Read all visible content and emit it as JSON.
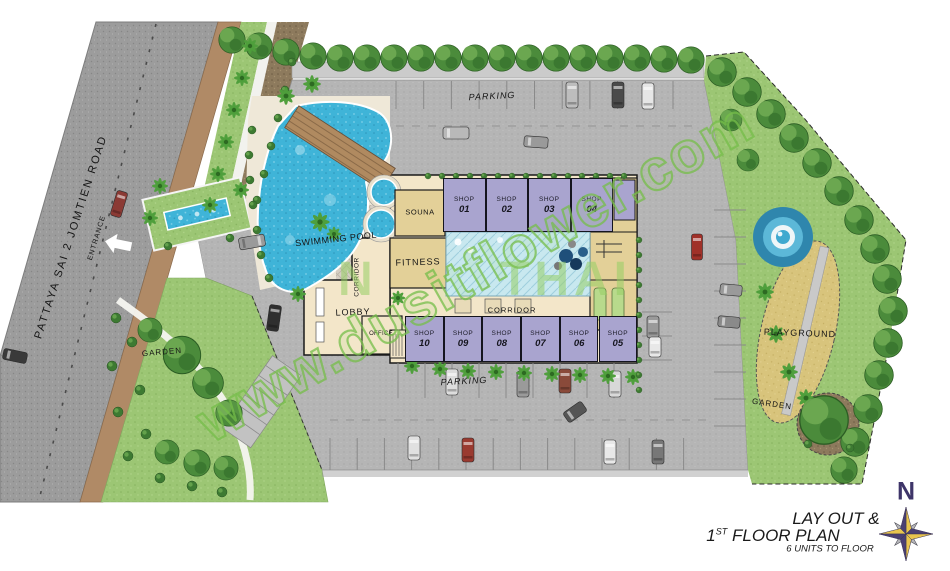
{
  "watermark": {
    "text": "www.dusitflower.com",
    "fragments": [
      "N",
      "THAI"
    ]
  },
  "road": {
    "label": "PATTAYA SAI 2 JOMTIEN ROAD",
    "entrance_label": "ENTRANCE"
  },
  "site": {
    "parking_top_label": "PARKING",
    "parking_bottom_label": "PARKING",
    "garden_left_label": "GARDEN",
    "garden_right_label": "GARDEN",
    "playground_label": "PLAYGROUND"
  },
  "building": {
    "swimming_pool_label": "SWIMMING POOL",
    "sauna_label": "SOUNA",
    "fitness_label": "FITNESS",
    "lobby_label": "LOBBY",
    "office_label": "OFFICE",
    "corridor_vertical_label": "CORRIDOR",
    "corridor_label": "CORRIDOR",
    "shops_top": [
      {
        "name": "SHOP",
        "number": "01"
      },
      {
        "name": "SHOP",
        "number": "02"
      },
      {
        "name": "SHOP",
        "number": "03"
      },
      {
        "name": "SHOP",
        "number": "04"
      }
    ],
    "shops_bottom": [
      {
        "name": "SHOP",
        "number": "10"
      },
      {
        "name": "SHOP",
        "number": "09"
      },
      {
        "name": "SHOP",
        "number": "08"
      },
      {
        "name": "SHOP",
        "number": "07"
      },
      {
        "name": "SHOP",
        "number": "06"
      },
      {
        "name": "SHOP",
        "number": "05"
      }
    ]
  },
  "title_block": {
    "line1": "LAY OUT &",
    "line2_num": "1",
    "line2_sup": "ST",
    "line2_rest": " FLOOR PLAN",
    "line3": "6 UNITS TO FLOOR"
  },
  "compass": {
    "north_label": "N"
  },
  "colors": {
    "watermark_green": "#76be4a",
    "shop_lavender": "#a9a4cf",
    "pool_blue": "#3fb4d8",
    "grass_green": "#9cc674",
    "road_gray": "#9c9c9c",
    "sand_tan": "#d8c47c",
    "building_cream": "#f3e6c9",
    "room_tan": "#e3d098",
    "compass_purple": "#3e3569"
  }
}
